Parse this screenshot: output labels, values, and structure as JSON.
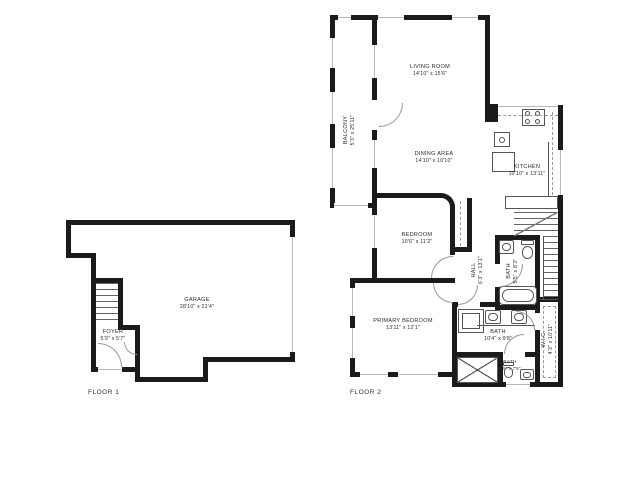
{
  "floor1": {
    "label": "FLOOR 1",
    "rooms": {
      "garage": {
        "name": "GARAGE",
        "dims": "28'10\" x 21'4\""
      },
      "foyer": {
        "name": "FOYER",
        "dims": "5'9\" x 5'7\""
      }
    }
  },
  "floor2": {
    "label": "FLOOR 2",
    "rooms": {
      "balcony": {
        "name": "BALCONY",
        "dims": "5'3\" x 25'11\""
      },
      "living_room": {
        "name": "LIVING ROOM",
        "dims": "14'10\" x 15'6\""
      },
      "dining_area": {
        "name": "DINING AREA",
        "dims": "14'10\" x 10'10\""
      },
      "kitchen": {
        "name": "KITCHEN",
        "dims": "10'10\" x 13'11\""
      },
      "bedroom": {
        "name": "BEDROOM",
        "dims": "10'6\" x 11'2\""
      },
      "hall": {
        "name": "HALL",
        "dims": "6'3\" x 13'1\""
      },
      "bath_upper": {
        "name": "BATH",
        "dims": "5'5\" x 8'3\""
      },
      "primary_bedroom": {
        "name": "PRIMARY BEDROOM",
        "dims": "13'11\" x 12'1\""
      },
      "bath_primary": {
        "name": "BATH",
        "dims": "10'4\" x 9'8\""
      },
      "wic": {
        "name": "W.I.C.",
        "dims": "4'3\" x 10'11\""
      },
      "bath_small": {
        "name": "BATH",
        "dims": "5'5\" x 7'5\""
      }
    }
  },
  "colors": {
    "wall": "#1b1b1b",
    "window_line": "#b8b8b8",
    "fixture": "#555555",
    "text": "#2b2b2b",
    "background": "#ffffff"
  }
}
